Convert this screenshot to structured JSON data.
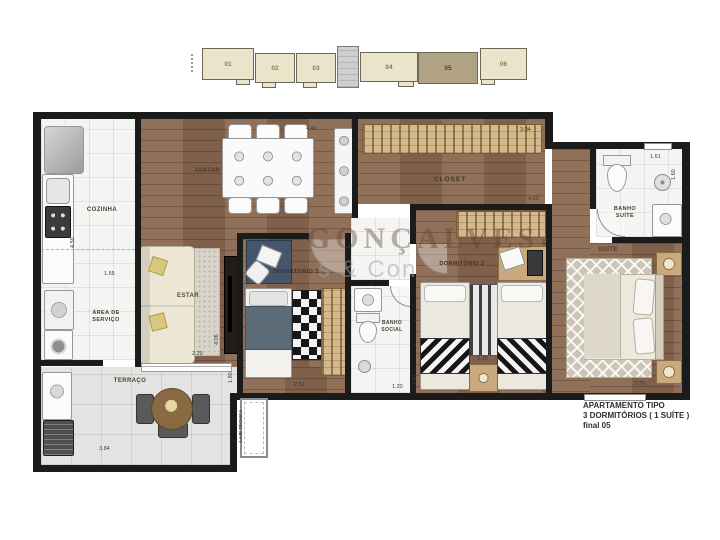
{
  "key_plan": {
    "units": [
      {
        "label": "01",
        "highlighted": false
      },
      {
        "label": "02",
        "highlighted": false
      },
      {
        "label": "03",
        "highlighted": false
      },
      {
        "label": "04",
        "highlighted": false
      },
      {
        "label": "05",
        "highlighted": true
      },
      {
        "label": "06",
        "highlighted": false
      }
    ]
  },
  "watermark": {
    "line1": "GONÇALVES",
    "line2": "s & Con"
  },
  "rooms": {
    "cozinha": "COZINHA",
    "area_servico": "ÁREA DE SERVIÇO",
    "terraco": "TERRAÇO",
    "jantar": "JANTAR",
    "estar": "ESTAR",
    "dormitorio3": "DORMITÓRIO 3",
    "banho_social": "BANHO SOCIAL",
    "dormitorio2": "DORMITÓRIO 2",
    "closet": "CLOSET",
    "banho_suite": "BANHO SUÍTE",
    "suite": "SUÍTE",
    "laje_tecnica": "LAJE TÉCNICA"
  },
  "dims": {
    "cozinha_depth": "4.59",
    "cozinha_pass": "1.55",
    "jantar_width": "4.40",
    "closet_right": "3.04",
    "closet_width": "4.63",
    "banho_suite_width": "1.61",
    "banho_suite_depth": "1.60",
    "suite_width": "2.70",
    "dorm2_width": "2.35",
    "dorm2_depth": "2.40",
    "banho_social_width": "1.20",
    "dorm3_width": "2.31",
    "dorm3_depth": "1.80",
    "estar_depth": "4.06",
    "estar_width": "2.29",
    "terraco_width": "3.84"
  },
  "title_block": {
    "line1": "APARTAMENTO  TIPO",
    "line2": "3 DORMITÓRIOS ( 1 SUÍTE )",
    "line3": "final 05"
  },
  "colors": {
    "wood": "#8a6750",
    "wall": "#1b1b1b",
    "tile": "#f4f4f2",
    "terrace_tile": "#e3e3e1",
    "rack": "#d3b98c",
    "unit_beige": "#ebe4ca",
    "unit_highlight": "#b2a284",
    "watermark": "rgba(95,65,38,0.40)"
  }
}
